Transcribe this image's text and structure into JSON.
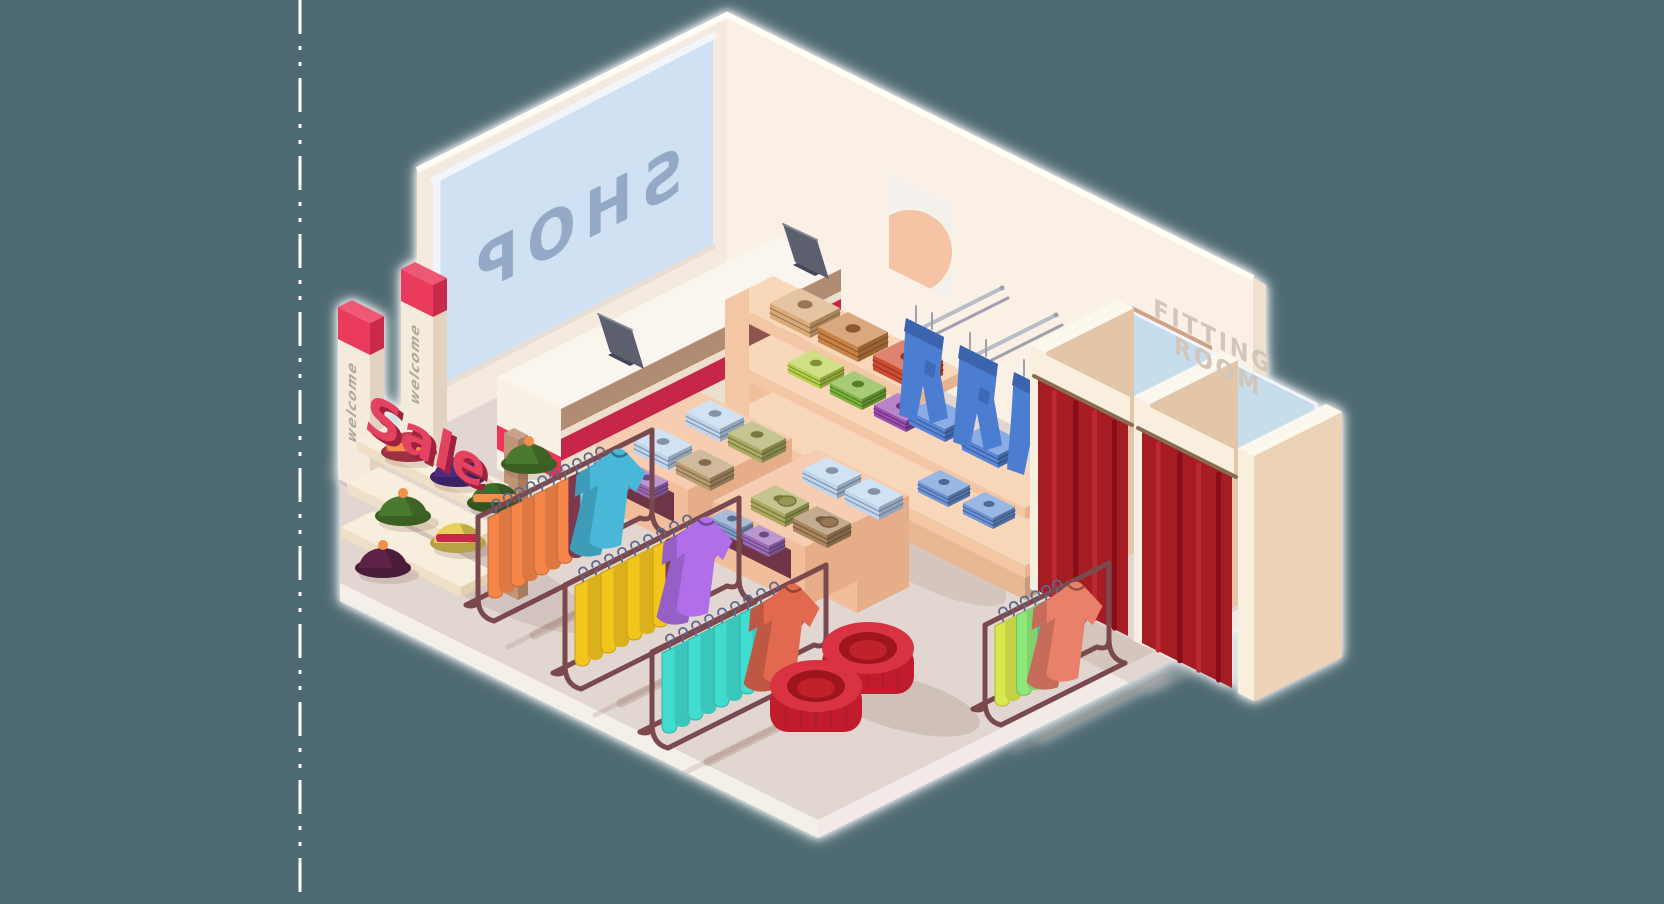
{
  "scene": {
    "description": "Isometric illustration of a clothing shop interior seen from above, on a teal canvas with a white dashed guide line on the left"
  },
  "texts": {
    "shop_sign": "SHOP",
    "welcome_banner": "welcome",
    "sale_sign": "Sale",
    "fitting_room_line1": "FITTING",
    "fitting_room_line2": "ROOM"
  },
  "palette": {
    "background": "#4d6971",
    "separator": "#ffffff",
    "floor": "#e2d6d1",
    "floor_edge_left": "#f5efe9",
    "floor_edge_right": "#f1eae6",
    "wall_left": "#f5eadf",
    "wall_right": "#fbf0e5",
    "wall_cap": "#efe0d0",
    "roof_edge": "#fffdf6",
    "window_glass": "#cfe1f3",
    "window_frame": "#f2f6fb",
    "shop_text": "#93a9c5",
    "poster_bg": "#f4f0ec",
    "poster_sun": "#f6c4a4",
    "fitting_text": "#d2c5ba",
    "counter_top": "#fbf6ed",
    "counter_bright": "#f8f0e4",
    "counter_shade": "#ecdfcc",
    "stripe_bright": "#ee3458",
    "stripe_dark": "#c62546",
    "counter_wood": "#b28b73",
    "monitor_screen": "#5b5f6e",
    "monitor_dark": "#42465a",
    "totem_body": "#f4ebdd",
    "totem_side": "#e3d2bf",
    "totem_top": "#fdf9f0",
    "totem_cap": "#ea3a5c",
    "totem_cap_shade": "#c92a48",
    "totem_text": "#b3a89d",
    "hat_shelf_top": "#f8eedd",
    "hat_shelf_front": "#efdfc6",
    "hat_shelf_side": "#e4d0b0",
    "pole": "#c09478",
    "pole_dark": "#a87c5f",
    "sale_front": "#e34261",
    "sale_side": "#9e2240",
    "shelf_top": "#f8d7ba",
    "shelf_bright": "#f3c6a4",
    "shelf_shade": "#e7b48f",
    "shelf_lower": "#f0c09c",
    "shelf_plinth": "#e9b693",
    "niche_dark": "#8f5350",
    "table_niche": "#6e3546",
    "rail_metal": "#b9bcc4",
    "rail_metal_dark": "#9ea1ab",
    "jean_blue": "#4c7ed0",
    "jean_dark": "#3a63ae",
    "table_top": "#f6cdb0",
    "table_bright": "#f2bd9a",
    "table_shade": "#e6ad89",
    "booth_top": "#fdf8ee",
    "booth_front": "#f9efdf",
    "booth_inner": "#e3c6a8",
    "booth_outer": "#ecd2b6",
    "booth_lower": "#ead0b4",
    "mirror": "#c6ddeb",
    "mirror_frame": "#f0f6fa",
    "trim_brown": "#cf9f86",
    "curtain": "#a51a22",
    "curtain_dark": "#871016",
    "curtain_light": "#bb2a33",
    "rod": "#8a6a55",
    "rack_metal": "#7a4a4e",
    "hanger": "#5c6890",
    "pouf_side": "#c11e2e",
    "pouf_top": "#d93340",
    "pouf_ring": "#9e121d",
    "pouf_inner": "#c0202c"
  },
  "objects": {
    "checkout_counter": {
      "monitors": 2,
      "stripe_color": "#ee3458"
    },
    "welcome_totems": {
      "count": 2
    },
    "sale_display": {
      "tiers": 3,
      "hats": [
        {
          "dome": "#c63d56",
          "band": "#f09048"
        },
        {
          "dome": "#4b2a80"
        },
        {
          "dome": "#3f6b2a",
          "band": "#f09048"
        },
        {
          "dome": "#4c7a2d",
          "pom": "#f09048"
        },
        {
          "dome": "#4c7a2d",
          "pom": "#f09048"
        },
        {
          "dome": "#e8d05a",
          "band": "#c8274c"
        },
        {
          "dome": "#b53048",
          "band": "#f09048"
        },
        {
          "dome": "#5e2347",
          "pom": "#f09048"
        }
      ]
    },
    "wall_shelf": {
      "top_stacks": [
        "#d9a876",
        "#c87f41",
        "#cc4a2e"
      ],
      "cubby_stacks": [
        "#b8d24a",
        "#7ab33a",
        "#9a4ab0"
      ],
      "jeans_hanging": 3,
      "jeans_folded": [
        "#5585d8",
        "#5585d8",
        "#6b93d6",
        "#6b93d6"
      ]
    },
    "tables": [
      {
        "top": [
          "#bcd4ee",
          "#aaaa60"
        ],
        "front": [
          "#bcd4ee",
          "#b89a6e"
        ],
        "cubby": [
          "#7f9cc8",
          "#9a68b8"
        ],
        "rings": false
      },
      {
        "top": [
          "#bcd4ee",
          "#bcd4ee"
        ],
        "front": [
          "#a8a85c",
          "#a8845c"
        ],
        "cubby": [
          "#7f9cc8",
          "#9a68b8"
        ],
        "rings": true
      }
    ],
    "racks": [
      {
        "groups": [
          [
            "#f5854a",
            7
          ],
          [
            "#8a3d56",
            1
          ],
          [
            "#74cfe2",
            2
          ]
        ],
        "displayed": "#49b8d8"
      },
      {
        "groups": [
          [
            "#f2c51d",
            7
          ],
          [
            "#8a3d56",
            1
          ],
          [
            "#a85fe0",
            1
          ]
        ],
        "displayed": "#b06ee8"
      },
      {
        "groups": [
          [
            "#40dcd0",
            8
          ],
          [
            "#8a3d56",
            1
          ]
        ],
        "displayed": "#e0694f"
      },
      {
        "groups": [
          [
            "#d9e84e",
            2
          ],
          [
            "#8fe87a",
            2
          ],
          [
            "#3fd2c4",
            2
          ]
        ],
        "displayed": "#e8806a"
      }
    ],
    "fitting_rooms": {
      "booths": 2,
      "curtain_color": "#a51a22"
    },
    "poufs": {
      "count": 2,
      "color": "#c11e2e"
    }
  }
}
